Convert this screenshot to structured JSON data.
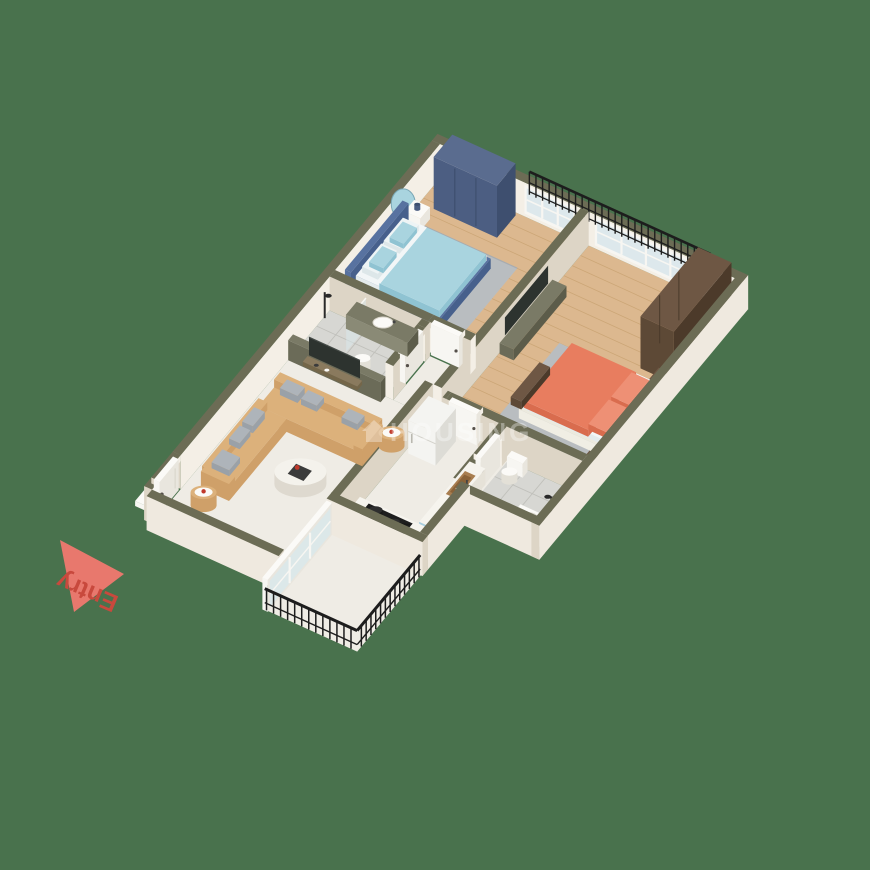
{
  "scene": {
    "background": "#49724d"
  },
  "watermark": {
    "text": "HOUSING",
    "icon": "house-icon",
    "color": "#ffffff",
    "opacity": 0.34
  },
  "entry": {
    "label": "Entry",
    "arrow_color": "#e8786d",
    "label_color": "#c8493d"
  },
  "palette": {
    "bg": "#49724d",
    "wallTop": "#6c6c55",
    "wallIn": "#f4efe6",
    "wallShade": "#ddd5c6",
    "wallOut": "#efe9df",
    "white": "#fbfaf7",
    "frame": "#f7f6f2",
    "glass": "#d9e7eb",
    "black": "#1d1d1d",
    "wood": "#dcb88f",
    "woodLine": "#c8a271",
    "marble": "#efece5",
    "marbleLine": "#e3dfd6",
    "tile": "#d7d7d3",
    "tileLine": "#c0c0bb",
    "rug": "#b9bdc0",
    "rugEdge": "#a8acb0",
    "navyF": "#4c5e82",
    "navyS": "#3e4f6f",
    "navyT": "#5a6c8f",
    "brownF": "#5d4936",
    "brownS": "#4c3a2a",
    "brownT": "#6e5744",
    "blueBed": "#a9d4df",
    "blueBedD": "#8fc3d2",
    "bedFrame": "#5872a0",
    "bedFrameD": "#47608c",
    "sheet": "#f2f6f7",
    "orange": "#e87d5f",
    "orangeD": "#d96c4e",
    "orangeP": "#ee9075",
    "tan": "#dcb17b",
    "tanD": "#cfa069",
    "pillow": "#aeb4ba",
    "pillowD": "#9aa1a8",
    "olive": "#6b6b58",
    "oliveT": "#7a7a66",
    "oliveD": "#5c5c4a",
    "woodShelf": "#8a7a5e",
    "woodShelfD": "#746649",
    "fridge": "#f4f4f1",
    "fridgeS": "#dddcd6",
    "cabBlue": "#a8cede",
    "cabBlueD": "#93bdcf",
    "counter": "#f6f4ee",
    "counterS": "#e6e2d8",
    "sinkBrown": "#a87d4f",
    "sinkBrownD": "#8a6238",
    "tv": "#2d332f",
    "mirror": "#a9d4df"
  }
}
